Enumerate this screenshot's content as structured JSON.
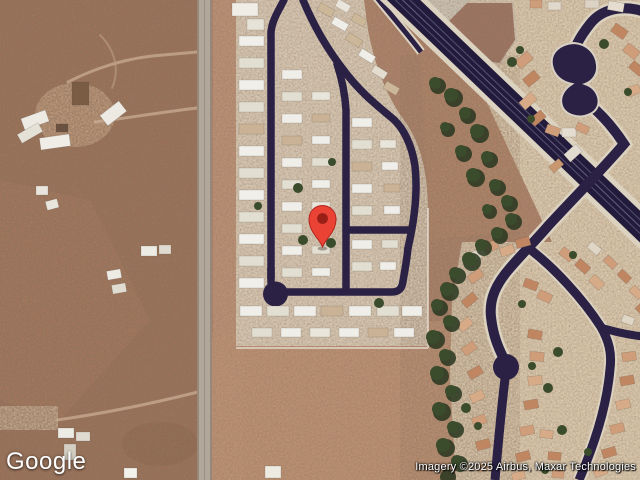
{
  "map": {
    "view_type": "satellite",
    "logo_text": "Google",
    "attribution": "Imagery ©2025 Airbus, Maxar Technologies",
    "marker": {
      "name": "red-location-pin",
      "approx_position_px": {
        "x": 322,
        "y": 225
      }
    }
  },
  "theme": {
    "desert-base": "#ab8168",
    "desert-dark": "#9b7057",
    "desert-pink": "#c29579",
    "park-ground": "#d5c6b2",
    "residential-ground": "#d9c8ad",
    "road-navy": "#2a2145",
    "shoulder": "#dcd2c0",
    "gray-road": "#b2a79b",
    "tree-green": "#3a4c2c",
    "tree-dark": "#28361f",
    "marker-red": "#EA4335",
    "marker-edge": "#b3241c",
    "marker-hole": "#991f17"
  }
}
